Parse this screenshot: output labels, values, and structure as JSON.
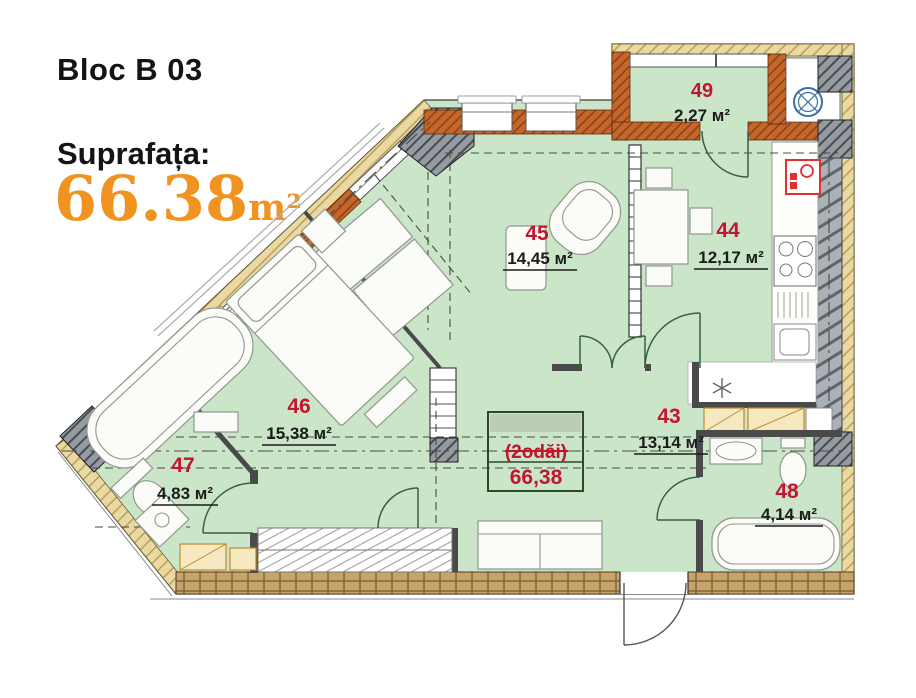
{
  "header": {
    "block_title": "Bloc B 03",
    "surface_label": "Suprafața:",
    "surface_value": "66.38",
    "surface_unit": "m²"
  },
  "stamp": {
    "type_label": "(2odăi)",
    "total_area": "66,38"
  },
  "rooms": [
    {
      "number": "49",
      "area": "2,27 м²"
    },
    {
      "number": "45",
      "area": "14,45 м²"
    },
    {
      "number": "44",
      "area": "12,17 м²"
    },
    {
      "number": "46",
      "area": "15,38 м²"
    },
    {
      "number": "47",
      "area": "4,83 м²"
    },
    {
      "number": "43",
      "area": "13,14 м²"
    },
    {
      "number": "48",
      "area": "4,14 м²"
    }
  ],
  "colors": {
    "accent_orange": "#f09321",
    "label_red": "#c2152f",
    "room_green": "#cbe5c8",
    "wall_orange": "#c4672c",
    "outer_tan": "#ead9a2",
    "structure_gray": "#959ba1",
    "fan_blue": "#3a6ea8",
    "panel_red": "#e03030"
  }
}
